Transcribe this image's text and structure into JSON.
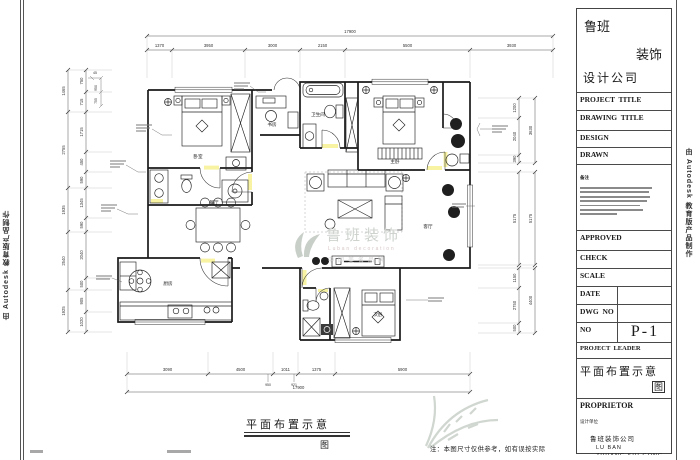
{
  "sheet": {
    "autodesk_credit": "由 Autodesk 教育版产品制作"
  },
  "title_block": {
    "company_line1": "鲁班",
    "company_line2": "装饰",
    "company_line3": "设计公司",
    "project_title_label": "PROJECT  TITLE",
    "drawing_title_label": "DRAWING  TITLE",
    "drawing_title_sub": "图纸名称",
    "design_label": "DESIGN",
    "design_sub": "设计",
    "design_value": "张情",
    "drawn_label": "DRAWN",
    "drawn_sub": "绘图",
    "drawn_value": "张情",
    "notes_label": "备注",
    "approved_label": "APPROVED",
    "approved_sub": "审定",
    "check_label": "CHECK",
    "check_sub": "审核",
    "scale_label": "SCALE",
    "scale_sub": "比例",
    "date_label": "DATE",
    "date_sub": "日期",
    "dwg_no_label": "DWG  NO",
    "dwg_no_sub": "图号",
    "no_label": "NO",
    "no_sub": "图别",
    "sheet_number": "P-1",
    "project_leader_label": "PROJECT  LEADER",
    "project_leader_sub": "工程负责",
    "drawing_name": "平面布置示意",
    "drawing_name_suffix": "图",
    "proprietor_label": "PROPRIETOR",
    "proprietor_sub": "设计单位",
    "proprietor_company": "鲁班装饰公司",
    "proprietor_pinyin1": "LU  BAN",
    "proprietor_pinyin2": "ZHUANG  SHI  GONG  SI"
  },
  "footer": {
    "drawing_caption": "平面布置示意",
    "drawing_caption_suffix": "图",
    "note": "注：本图尺寸仅供参考，如有误按实际"
  },
  "watermark": {
    "name": "鲁班装饰",
    "sub_en": "Luban decoration",
    "sub_cn": "中国美名品牌"
  },
  "floor_plan": {
    "room_labels": [
      "卧室",
      "书房",
      "卫生间",
      "主卧",
      "客厅",
      "餐厅",
      "厨房",
      "次卧"
    ],
    "dimensions": {
      "top": {
        "overall": "17900",
        "segments": [
          "1370",
          "3950",
          "3000",
          "2150",
          "5500",
          "3930"
        ]
      },
      "bottom": {
        "overall": "17900",
        "segments": [
          "3090",
          "4500",
          "1011",
          "1375",
          "5900"
        ],
        "minor": [
          "950",
          "921"
        ]
      },
      "left": {
        "outer": [
          "1465",
          "2755",
          "1935",
          "2540",
          "1925"
        ],
        "inner": [
          "750",
          "715",
          "1715",
          "450",
          "590",
          "1345",
          "590",
          "2040",
          "500",
          "905",
          "1020"
        ]
      },
      "right": {
        "outer": [
          "3630",
          "5175",
          "4400"
        ],
        "inner": [
          "1200",
          "2040",
          "390",
          "5175",
          "1150",
          "2750",
          "500"
        ]
      },
      "detail": [
        "45",
        "950",
        "755"
      ]
    },
    "colors": {
      "door_highlight": "#f7f3a2",
      "wall": "#1a1a1a",
      "dim": "#555555",
      "watermark": "#ccd2cc"
    }
  }
}
